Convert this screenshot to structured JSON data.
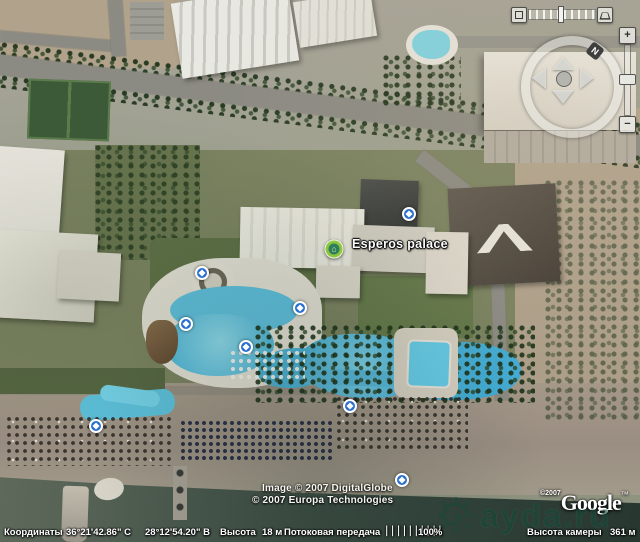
{
  "map": {
    "place_label": "Esperos palace",
    "photo_markers": [
      {
        "x": 409,
        "y": 214
      },
      {
        "x": 202,
        "y": 273
      },
      {
        "x": 186,
        "y": 324
      },
      {
        "x": 246,
        "y": 347
      },
      {
        "x": 300,
        "y": 308
      },
      {
        "x": 96,
        "y": 426
      },
      {
        "x": 350,
        "y": 406
      },
      {
        "x": 402,
        "y": 480
      }
    ]
  },
  "navigator": {
    "north_label": "N",
    "zoom_in_label": "+",
    "zoom_out_label": "−"
  },
  "attribution": {
    "line1": "Image © 2007 DigitalGlobe",
    "line2": "© 2007 Europa Technologies",
    "google_year": "©2007",
    "google": "Google",
    "google_tm": "™"
  },
  "watermark": {
    "text": "ayda.ru"
  },
  "statusbar": {
    "coords_label": "Координаты",
    "latitude": "36°21'42.86\" С",
    "longitude": "28°12'54.20\" В",
    "altitude_label": "Высота",
    "altitude_value": "18 м",
    "streaming_label": "Потоковая передача",
    "streaming_bars": "||||||||||",
    "streaming_pct": "100%",
    "camera_alt_label": "Высота камеры",
    "camera_alt_value": "361 м"
  }
}
